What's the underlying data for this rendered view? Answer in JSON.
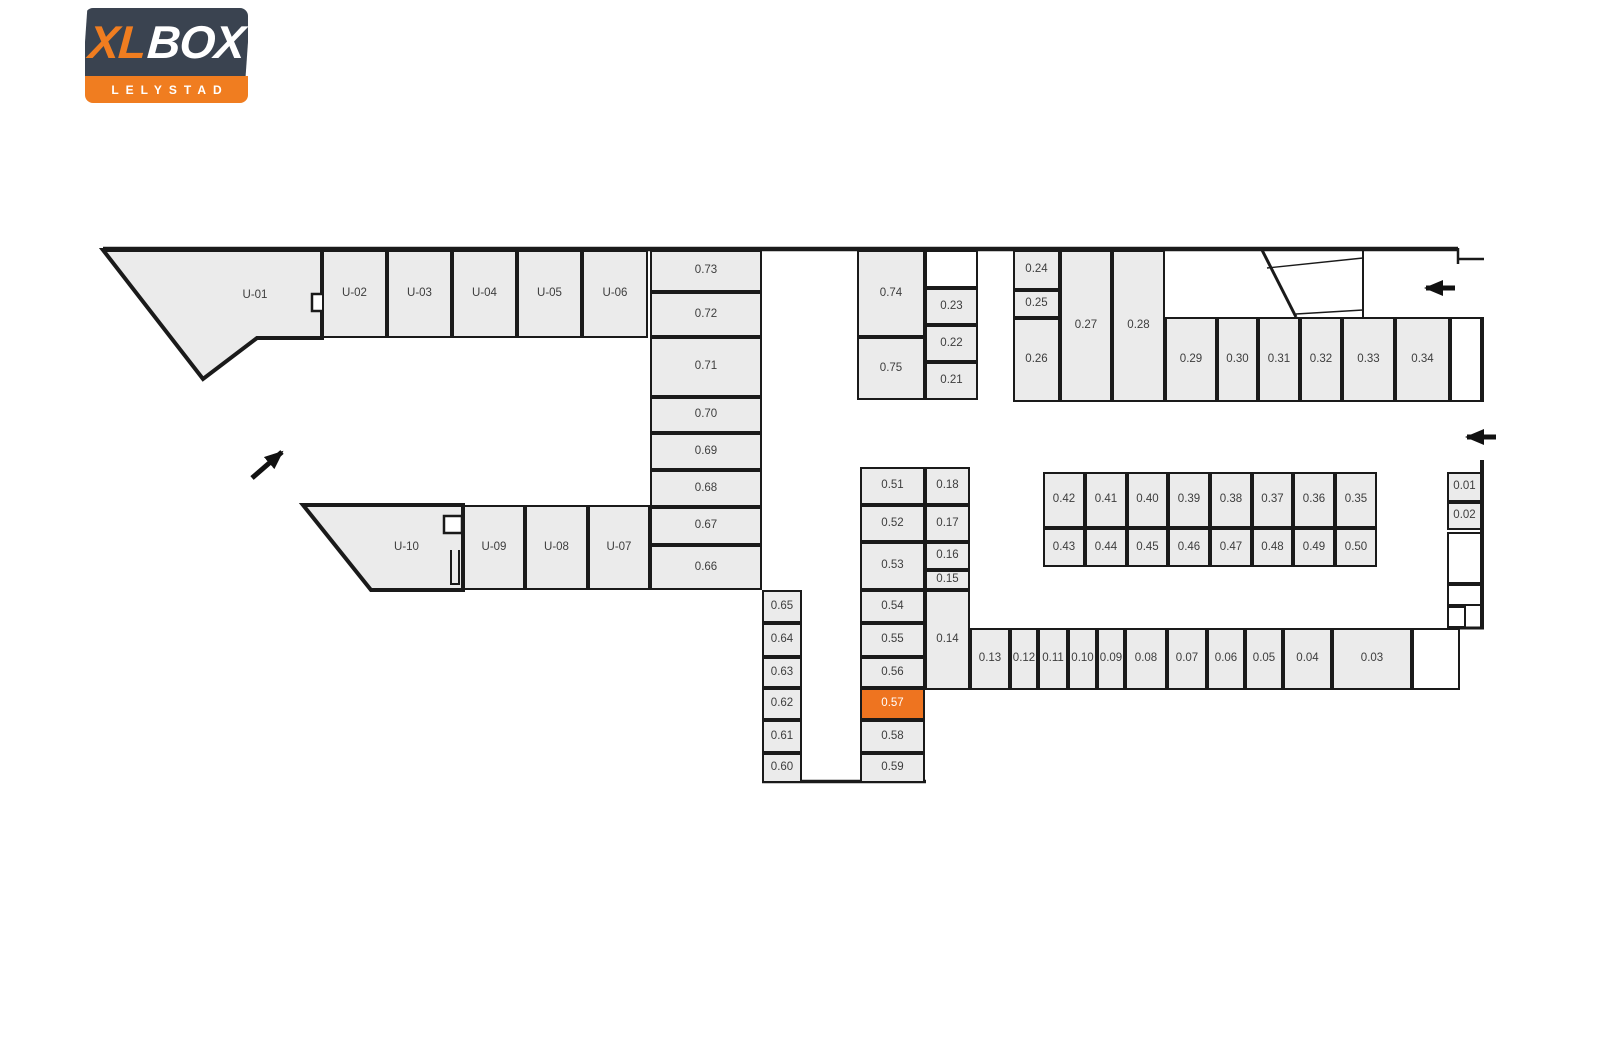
{
  "brand": {
    "name_part1": "XL",
    "name_part2": "BOX",
    "subtitle": "LELYSTAD",
    "navy": "#3a4350",
    "orange": "#f07d20"
  },
  "colors": {
    "unit_fill": "#ebebeb",
    "wall": "#1a1a1a",
    "unit_label": "#3d3d3d",
    "highlight": "#ee7420",
    "highlight_text": "#ffffff"
  },
  "selected_unit": "0.57",
  "icons": {
    "entrance_arrow_ne": "arrow-up-right",
    "corridor_arrow_top": "arrow-left",
    "corridor_arrow_mid": "arrow-left",
    "stair_glyph_top": "stair-direction",
    "stair_glyph_right": "stair-direction"
  },
  "floorplan": {
    "units": [
      {
        "label": "U-01",
        "x": 190,
        "y": 252,
        "w": 130,
        "h": 88,
        "v": "ghost"
      },
      {
        "label": "U-02",
        "x": 322,
        "y": 250,
        "w": 65,
        "h": 88
      },
      {
        "label": "U-03",
        "x": 387,
        "y": 250,
        "w": 65,
        "h": 88
      },
      {
        "label": "U-04",
        "x": 452,
        "y": 250,
        "w": 65,
        "h": 88
      },
      {
        "label": "U-05",
        "x": 517,
        "y": 250,
        "w": 65,
        "h": 88
      },
      {
        "label": "U-06",
        "x": 582,
        "y": 250,
        "w": 66,
        "h": 88
      },
      {
        "label": "0.73",
        "x": 650,
        "y": 250,
        "w": 112,
        "h": 42
      },
      {
        "label": "0.72",
        "x": 650,
        "y": 292,
        "w": 112,
        "h": 45
      },
      {
        "label": "0.71",
        "x": 650,
        "y": 337,
        "w": 112,
        "h": 60
      },
      {
        "label": "0.70",
        "x": 650,
        "y": 397,
        "w": 112,
        "h": 36
      },
      {
        "label": "0.69",
        "x": 650,
        "y": 433,
        "w": 112,
        "h": 37
      },
      {
        "label": "0.68",
        "x": 650,
        "y": 470,
        "w": 112,
        "h": 37
      },
      {
        "label": "0.67",
        "x": 650,
        "y": 507,
        "w": 112,
        "h": 38
      },
      {
        "label": "0.66",
        "x": 650,
        "y": 545,
        "w": 112,
        "h": 45
      },
      {
        "label": "0.74",
        "x": 857,
        "y": 250,
        "w": 68,
        "h": 87
      },
      {
        "label": "0.75",
        "x": 857,
        "y": 337,
        "w": 68,
        "h": 63
      },
      {
        "label": "",
        "x": 925,
        "y": 250,
        "w": 53,
        "h": 38,
        "v": "white"
      },
      {
        "label": "0.23",
        "x": 925,
        "y": 288,
        "w": 53,
        "h": 37
      },
      {
        "label": "0.22",
        "x": 925,
        "y": 325,
        "w": 53,
        "h": 37
      },
      {
        "label": "0.21",
        "x": 925,
        "y": 362,
        "w": 53,
        "h": 38
      },
      {
        "label": "0.24",
        "x": 1013,
        "y": 250,
        "w": 47,
        "h": 40
      },
      {
        "label": "0.25",
        "x": 1013,
        "y": 290,
        "w": 47,
        "h": 28
      },
      {
        "label": "0.26",
        "x": 1013,
        "y": 318,
        "w": 47,
        "h": 84
      },
      {
        "label": "0.27",
        "x": 1060,
        "y": 250,
        "w": 52,
        "h": 152
      },
      {
        "label": "0.28",
        "x": 1112,
        "y": 250,
        "w": 53,
        "h": 152
      },
      {
        "label": "0.29",
        "x": 1165,
        "y": 317,
        "w": 52,
        "h": 85
      },
      {
        "label": "0.30",
        "x": 1217,
        "y": 317,
        "w": 41,
        "h": 85
      },
      {
        "label": "0.31",
        "x": 1258,
        "y": 317,
        "w": 42,
        "h": 85
      },
      {
        "label": "0.32",
        "x": 1300,
        "y": 317,
        "w": 42,
        "h": 85
      },
      {
        "label": "0.33",
        "x": 1342,
        "y": 317,
        "w": 53,
        "h": 85
      },
      {
        "label": "0.34",
        "x": 1395,
        "y": 317,
        "w": 55,
        "h": 85
      },
      {
        "label": "",
        "x": 1450,
        "y": 317,
        "w": 32,
        "h": 85,
        "v": "white"
      },
      {
        "label": "0.42",
        "x": 1043,
        "y": 472,
        "w": 42,
        "h": 56
      },
      {
        "label": "0.41",
        "x": 1085,
        "y": 472,
        "w": 42,
        "h": 56
      },
      {
        "label": "0.40",
        "x": 1127,
        "y": 472,
        "w": 41,
        "h": 56
      },
      {
        "label": "0.39",
        "x": 1168,
        "y": 472,
        "w": 42,
        "h": 56
      },
      {
        "label": "0.38",
        "x": 1210,
        "y": 472,
        "w": 42,
        "h": 56
      },
      {
        "label": "0.37",
        "x": 1252,
        "y": 472,
        "w": 41,
        "h": 56
      },
      {
        "label": "0.36",
        "x": 1293,
        "y": 472,
        "w": 42,
        "h": 56
      },
      {
        "label": "0.35",
        "x": 1335,
        "y": 472,
        "w": 42,
        "h": 56
      },
      {
        "label": "0.43",
        "x": 1043,
        "y": 528,
        "w": 42,
        "h": 39
      },
      {
        "label": "0.44",
        "x": 1085,
        "y": 528,
        "w": 42,
        "h": 39
      },
      {
        "label": "0.45",
        "x": 1127,
        "y": 528,
        "w": 41,
        "h": 39
      },
      {
        "label": "0.46",
        "x": 1168,
        "y": 528,
        "w": 42,
        "h": 39
      },
      {
        "label": "0.47",
        "x": 1210,
        "y": 528,
        "w": 42,
        "h": 39
      },
      {
        "label": "0.48",
        "x": 1252,
        "y": 528,
        "w": 41,
        "h": 39
      },
      {
        "label": "0.49",
        "x": 1293,
        "y": 528,
        "w": 42,
        "h": 39
      },
      {
        "label": "0.50",
        "x": 1335,
        "y": 528,
        "w": 42,
        "h": 39
      },
      {
        "label": "0.01",
        "x": 1447,
        "y": 472,
        "w": 35,
        "h": 30
      },
      {
        "label": "0.02",
        "x": 1447,
        "y": 502,
        "w": 35,
        "h": 28
      },
      {
        "label": "",
        "x": 1447,
        "y": 532,
        "w": 35,
        "h": 52,
        "v": "white"
      },
      {
        "label": "",
        "x": 1447,
        "y": 584,
        "w": 35,
        "h": 22,
        "v": "white"
      },
      {
        "label": "",
        "x": 1447,
        "y": 606,
        "w": 19,
        "h": 22,
        "v": "white"
      },
      {
        "label": "0.18",
        "x": 925,
        "y": 467,
        "w": 45,
        "h": 38
      },
      {
        "label": "0.17",
        "x": 925,
        "y": 505,
        "w": 45,
        "h": 37
      },
      {
        "label": "0.16",
        "x": 925,
        "y": 542,
        "w": 45,
        "h": 28
      },
      {
        "label": "0.15",
        "x": 925,
        "y": 570,
        "w": 45,
        "h": 20
      },
      {
        "label": "0.14",
        "x": 925,
        "y": 590,
        "w": 45,
        "h": 100
      },
      {
        "label": "0.13",
        "x": 970,
        "y": 628,
        "w": 40,
        "h": 62
      },
      {
        "label": "0.12",
        "x": 1010,
        "y": 628,
        "w": 28,
        "h": 62
      },
      {
        "label": "0.11",
        "x": 1038,
        "y": 628,
        "w": 30,
        "h": 62
      },
      {
        "label": "0.10",
        "x": 1068,
        "y": 628,
        "w": 29,
        "h": 62
      },
      {
        "label": "0.09",
        "x": 1097,
        "y": 628,
        "w": 28,
        "h": 62
      },
      {
        "label": "0.08",
        "x": 1125,
        "y": 628,
        "w": 42,
        "h": 62
      },
      {
        "label": "0.07",
        "x": 1167,
        "y": 628,
        "w": 40,
        "h": 62
      },
      {
        "label": "0.06",
        "x": 1207,
        "y": 628,
        "w": 38,
        "h": 62
      },
      {
        "label": "0.05",
        "x": 1245,
        "y": 628,
        "w": 38,
        "h": 62
      },
      {
        "label": "0.04",
        "x": 1283,
        "y": 628,
        "w": 49,
        "h": 62
      },
      {
        "label": "0.03",
        "x": 1332,
        "y": 628,
        "w": 80,
        "h": 62
      },
      {
        "label": "",
        "x": 1412,
        "y": 628,
        "w": 48,
        "h": 62,
        "v": "white"
      },
      {
        "label": "0.51",
        "x": 860,
        "y": 467,
        "w": 65,
        "h": 38
      },
      {
        "label": "0.52",
        "x": 860,
        "y": 505,
        "w": 65,
        "h": 37
      },
      {
        "label": "0.53",
        "x": 860,
        "y": 542,
        "w": 65,
        "h": 48
      },
      {
        "label": "0.54",
        "x": 860,
        "y": 590,
        "w": 65,
        "h": 33
      },
      {
        "label": "0.55",
        "x": 860,
        "y": 623,
        "w": 65,
        "h": 34
      },
      {
        "label": "0.56",
        "x": 860,
        "y": 657,
        "w": 65,
        "h": 31
      },
      {
        "label": "0.57",
        "x": 860,
        "y": 688,
        "w": 65,
        "h": 32
      },
      {
        "label": "0.58",
        "x": 860,
        "y": 720,
        "w": 65,
        "h": 33
      },
      {
        "label": "0.59",
        "x": 860,
        "y": 753,
        "w": 65,
        "h": 30
      },
      {
        "label": "0.65",
        "x": 762,
        "y": 590,
        "w": 40,
        "h": 33
      },
      {
        "label": "0.64",
        "x": 762,
        "y": 623,
        "w": 40,
        "h": 34
      },
      {
        "label": "0.63",
        "x": 762,
        "y": 657,
        "w": 40,
        "h": 31
      },
      {
        "label": "0.62",
        "x": 762,
        "y": 688,
        "w": 40,
        "h": 32
      },
      {
        "label": "0.61",
        "x": 762,
        "y": 720,
        "w": 40,
        "h": 33
      },
      {
        "label": "0.60",
        "x": 762,
        "y": 753,
        "w": 40,
        "h": 30
      },
      {
        "label": "U-10",
        "x": 350,
        "y": 505,
        "w": 113,
        "h": 85,
        "v": "ghost"
      },
      {
        "label": "U-09",
        "x": 463,
        "y": 505,
        "w": 62,
        "h": 85
      },
      {
        "label": "U-08",
        "x": 525,
        "y": 505,
        "w": 63,
        "h": 85
      },
      {
        "label": "U-07",
        "x": 588,
        "y": 505,
        "w": 62,
        "h": 85
      }
    ]
  }
}
